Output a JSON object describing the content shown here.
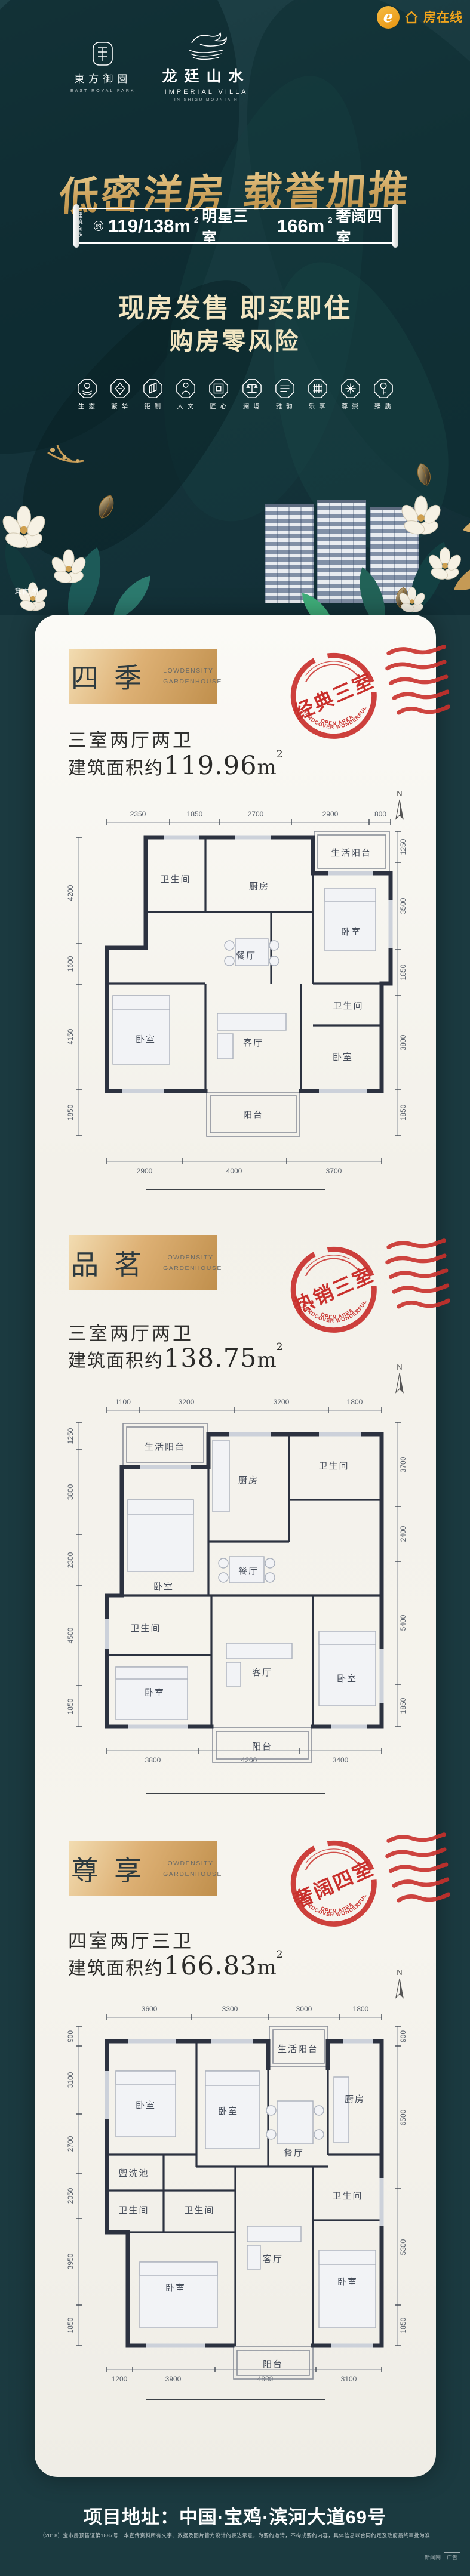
{
  "theme": {
    "bg": "#1b3a40",
    "gold": "#d3ab67",
    "stamp_red": "#c9302c",
    "card": "#f7f5ef",
    "portal_orange": "#efa31c"
  },
  "brand": {
    "logo_primary": {
      "name": "東方御園",
      "sub": "EAST ROYAL PARK"
    },
    "logo_secondary": {
      "name": "龙廷山水",
      "sub1": "IMPERIAL VILLA",
      "sub2": "IN SHIGU MOUNTAIN"
    },
    "portal": {
      "e": "e",
      "name": "房在线"
    }
  },
  "hero": {
    "title": "低密洋房 载誉加推",
    "banner": {
      "prefix_top": "建筑",
      "prefix_bottom": "面积",
      "approx": "约",
      "num1": "119/138m",
      "sup": "2",
      "seg1": "明星三室",
      "num2": "166m",
      "seg2": "奢阔四室"
    },
    "slogan_line1": "现房发售 即买即住",
    "slogan_line2": "购房零风险",
    "features": [
      {
        "label": "生 态",
        "sub": "···· ····"
      },
      {
        "label": "繁 华",
        "sub": "···· ····"
      },
      {
        "label": "钜 制",
        "sub": "···· ····"
      },
      {
        "label": "人 文",
        "sub": "···· ····"
      },
      {
        "label": "匠 心",
        "sub": "···· ····"
      },
      {
        "label": "澜 境",
        "sub": "···· ····"
      },
      {
        "label": "雅 韵",
        "sub": "···· ····"
      },
      {
        "label": "乐 享",
        "sub": "···· ····"
      },
      {
        "label": "尊 崇",
        "sub": "···· ····"
      },
      {
        "label": "臻 质",
        "sub": "···· ····"
      }
    ],
    "image_note": "意向图"
  },
  "stamp_arc1": "HARDCOVER WONDERFUL",
  "stamp_arc2": "OPEN AREA",
  "plans": [
    {
      "name": "四季",
      "tag_line1": "LOWDENSITY",
      "tag_line2": "GARDENHOUSE",
      "stamp": "经典三室",
      "layout": "三室两厅两卫",
      "area_prefix": "建筑面积约",
      "area_value": "119.96",
      "area_unit": "m",
      "area_sup": "2",
      "compass": "N",
      "rooms": [
        "卫生间",
        "厨房",
        "生活阳台",
        "卧室",
        "餐厅",
        "卫生间",
        "卧室",
        "客厅",
        "卧室",
        "阳台"
      ],
      "dims_top": [
        "2350",
        "1850",
        "2700",
        "2900",
        "800"
      ],
      "dims_left": [
        "4200",
        "1600",
        "4150",
        "1850"
      ],
      "dims_right": [
        "1250",
        "3500",
        "1850",
        "3800",
        "1850"
      ],
      "dims_bottom": [
        "2900",
        "4000",
        "3700"
      ]
    },
    {
      "name": "品茗",
      "tag_line1": "LOWDENSITY",
      "tag_line2": "GARDENHOUSE",
      "stamp": "热销三室",
      "layout": "三室两厅两卫",
      "area_prefix": "建筑面积约",
      "area_value": "138.75",
      "area_unit": "m",
      "area_sup": "2",
      "compass": "N",
      "rooms": [
        "生活阳台",
        "厨房",
        "卫生间",
        "卧室",
        "餐厅",
        "卫生间",
        "卧室",
        "客厅",
        "卧室",
        "阳台"
      ],
      "dims_top": [
        "1100",
        "3200",
        "3200",
        "1800"
      ],
      "dims_left": [
        "1250",
        "3800",
        "2300",
        "4500",
        "1850"
      ],
      "dims_right": [
        "3700",
        "2400",
        "5400",
        "1850"
      ],
      "dims_bottom": [
        "3800",
        "4200",
        "3400"
      ]
    },
    {
      "name": "尊享",
      "tag_line1": "LOWDENSITY",
      "tag_line2": "GARDENHOUSE",
      "stamp": "奢阔四室",
      "layout": "四室两厅三卫",
      "area_prefix": "建筑面积约",
      "area_value": "166.83",
      "area_unit": "m",
      "area_sup": "2",
      "compass": "N",
      "rooms": [
        "卧室",
        "卧室",
        "生活阳台",
        "厨房",
        "餐厅",
        "盥洗池",
        "卫生间",
        "卫生间",
        "卧室",
        "客厅",
        "卧室",
        "卫生间",
        "阳台"
      ],
      "dims_top": [
        "3600",
        "3300",
        "3000",
        "1800"
      ],
      "dims_left": [
        "900",
        "3100",
        "2700",
        "2050",
        "3950",
        "1850"
      ],
      "dims_right": [
        "900",
        "6500",
        "5300",
        "1850"
      ],
      "dims_bottom": [
        "1200",
        "3900",
        "4800",
        "3100"
      ]
    }
  ],
  "footer": {
    "address": "项目地址：中国·宝鸡·滨河大道69号",
    "disclaimer": "（2018）宝市房预售证第1887号　本宣传资料所有文字、数据及图片皆为设计的表达示意，为要约邀请，不构成要约内容，具体信息以合同约定及政府最终审批为准",
    "watermark": "新闻网",
    "ad_badge": "广告"
  }
}
